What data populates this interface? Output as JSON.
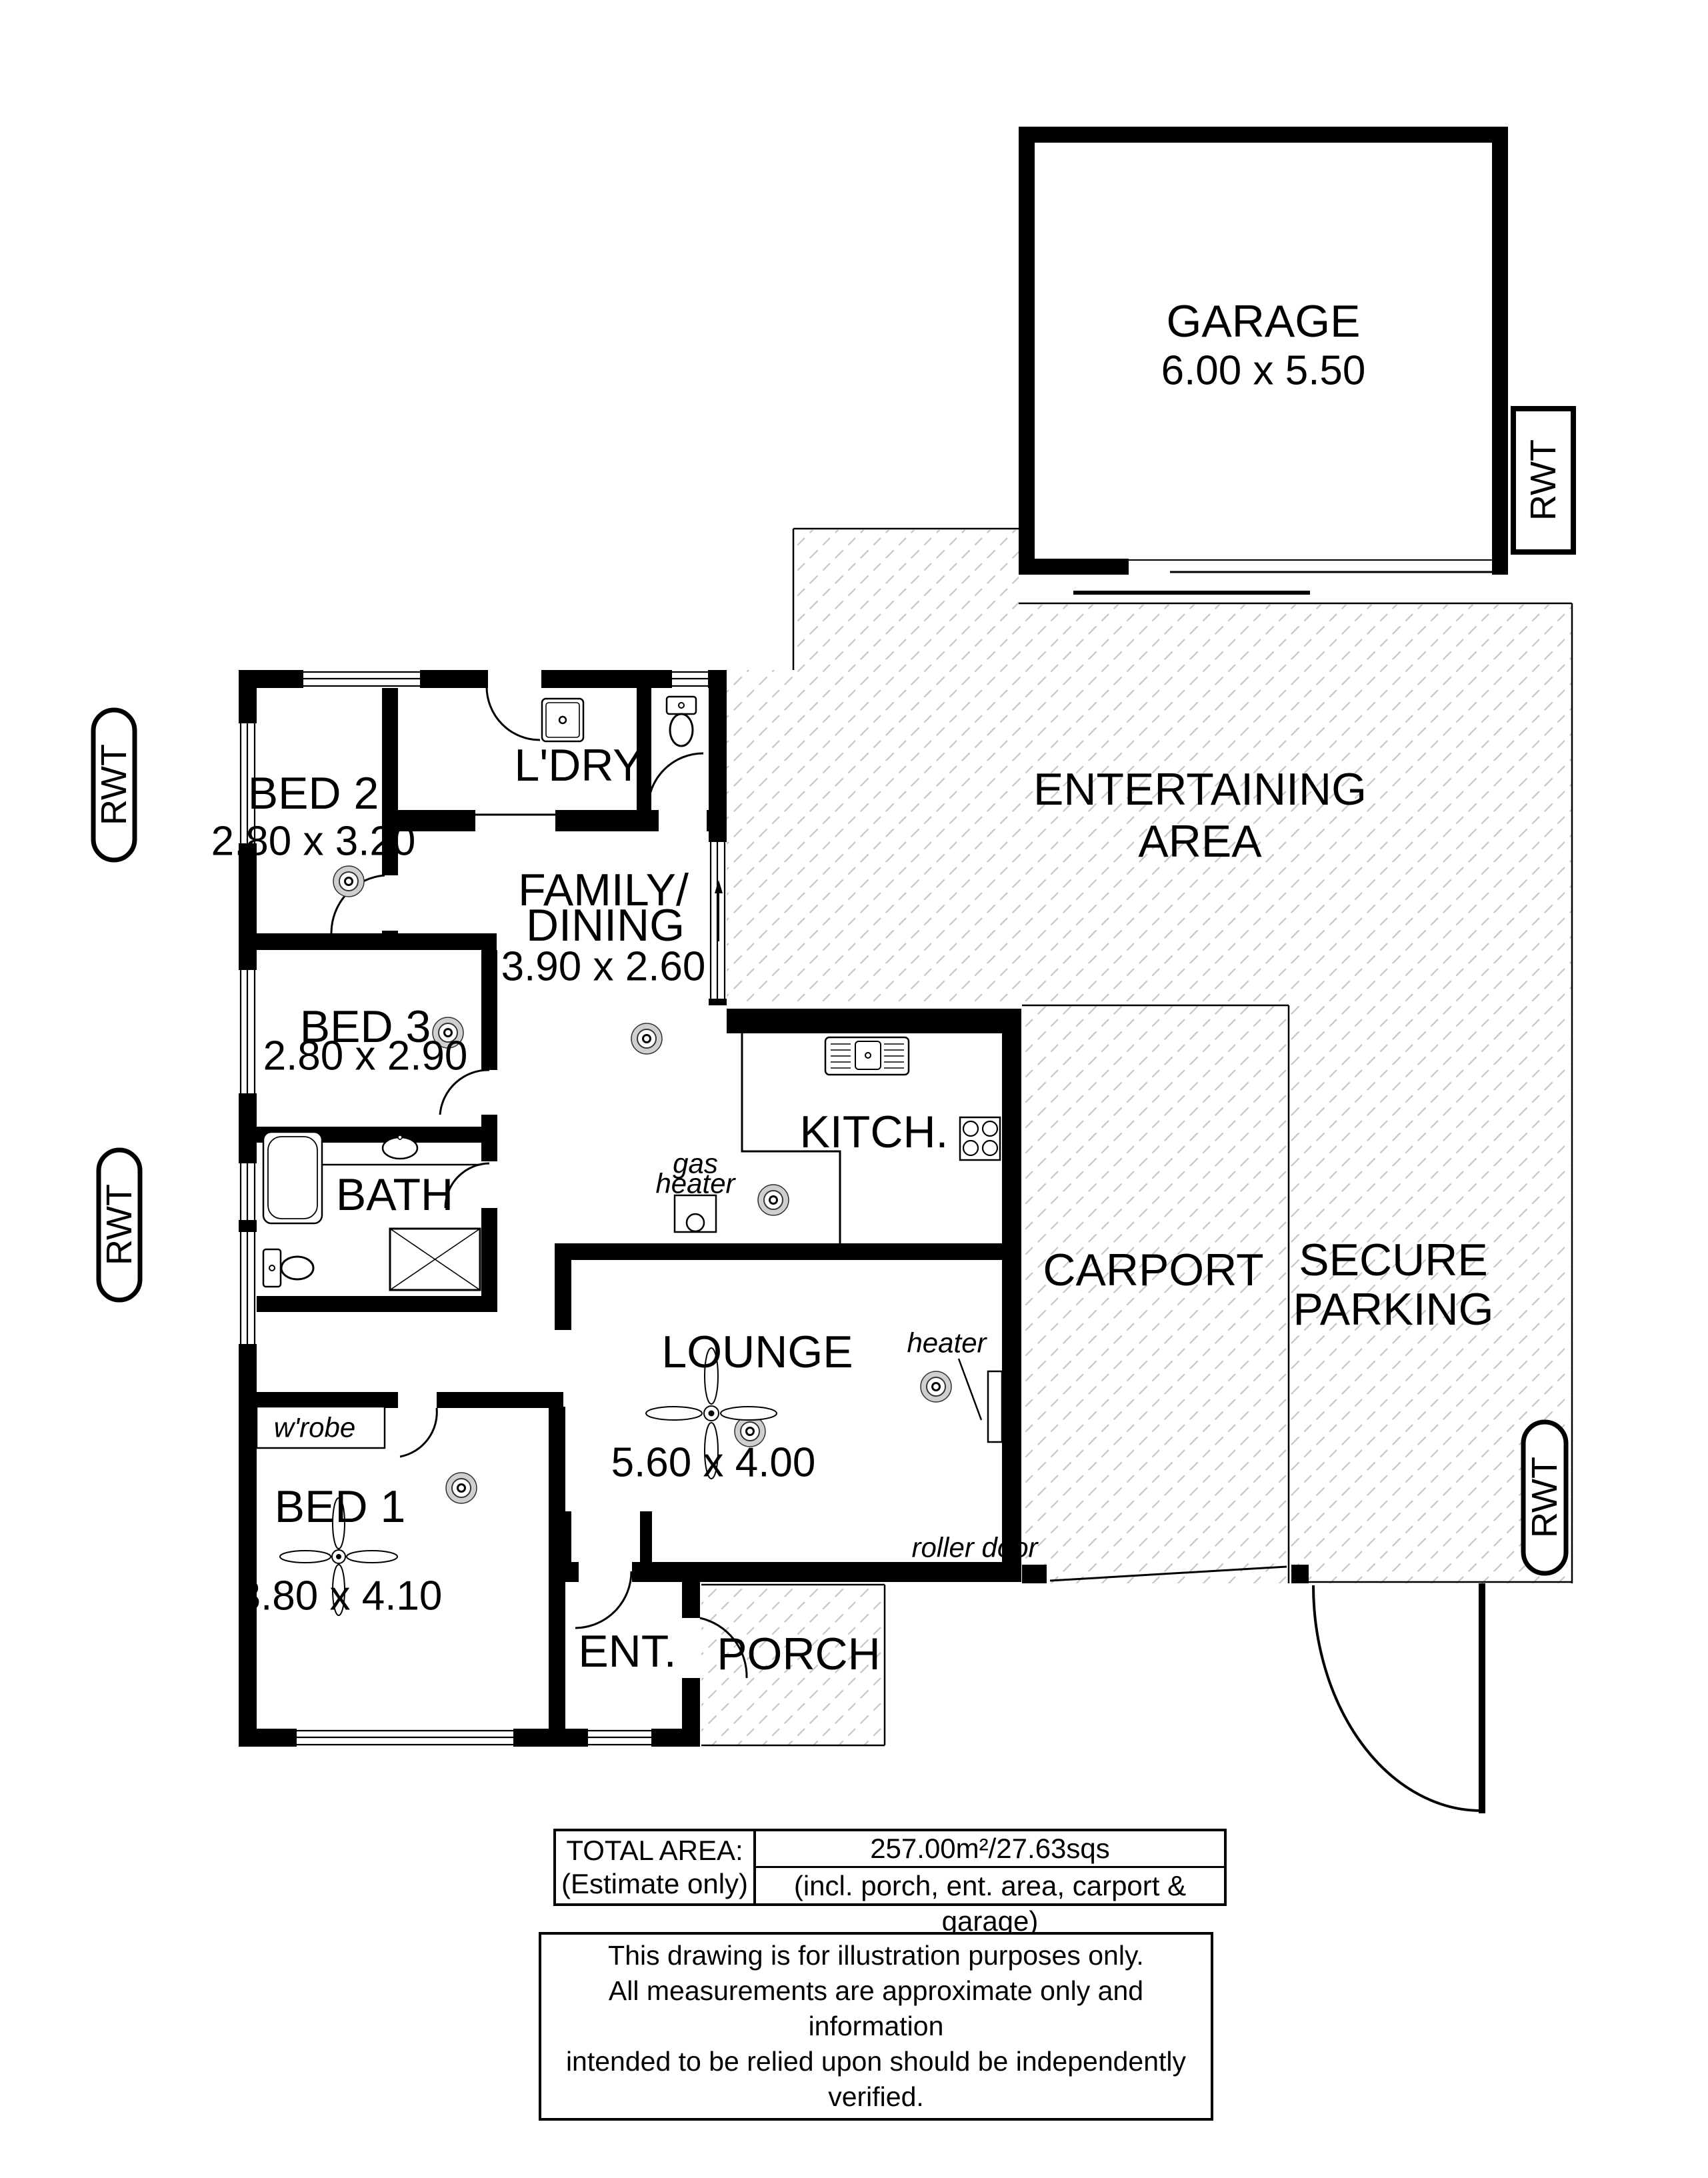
{
  "rooms": {
    "garage": {
      "name": "GARAGE",
      "dims": "6.00 x 5.50"
    },
    "entertaining": {
      "line1": "ENTERTAINING",
      "line2": "AREA"
    },
    "bed2": {
      "name": "BED 2",
      "dims": "2.80 x 3.20"
    },
    "bed3": {
      "name": "BED 3",
      "dims": "2.80 x 2.90"
    },
    "bed1": {
      "name": "BED 1",
      "dims": "3.80 x 4.10"
    },
    "laundry": {
      "name": "L'DRY"
    },
    "family": {
      "line1": "FAMILY/",
      "line2": "DINING",
      "dims": "3.90 x 2.60"
    },
    "kitchen": {
      "name": "KITCH."
    },
    "bath": {
      "name": "BATH"
    },
    "lounge": {
      "name": "LOUNGE",
      "dims": "5.60 x 4.00"
    },
    "ent": {
      "name": "ENT."
    },
    "porch": {
      "name": "PORCH"
    },
    "carport": {
      "name": "CARPORT"
    },
    "secure_parking": {
      "line1": "SECURE",
      "line2": "PARKING"
    }
  },
  "annotations": {
    "rwt": "RWT",
    "gas_heater_line1": "gas",
    "gas_heater_line2": "heater",
    "heater": "heater",
    "wrobe": "w'robe",
    "roller_door": "roller door"
  },
  "summary": {
    "total_area_label": "TOTAL AREA:",
    "estimate_label": "(Estimate only)",
    "total_area_value": "257.00m²/27.63sqs",
    "includes": "(incl. porch, ent. area, carport & garage)"
  },
  "disclaimer": {
    "line1": "This drawing is for illustration purposes only.",
    "line2": "All measurements are approximate only and information",
    "line3": "intended to be relied upon should be independently verified."
  }
}
